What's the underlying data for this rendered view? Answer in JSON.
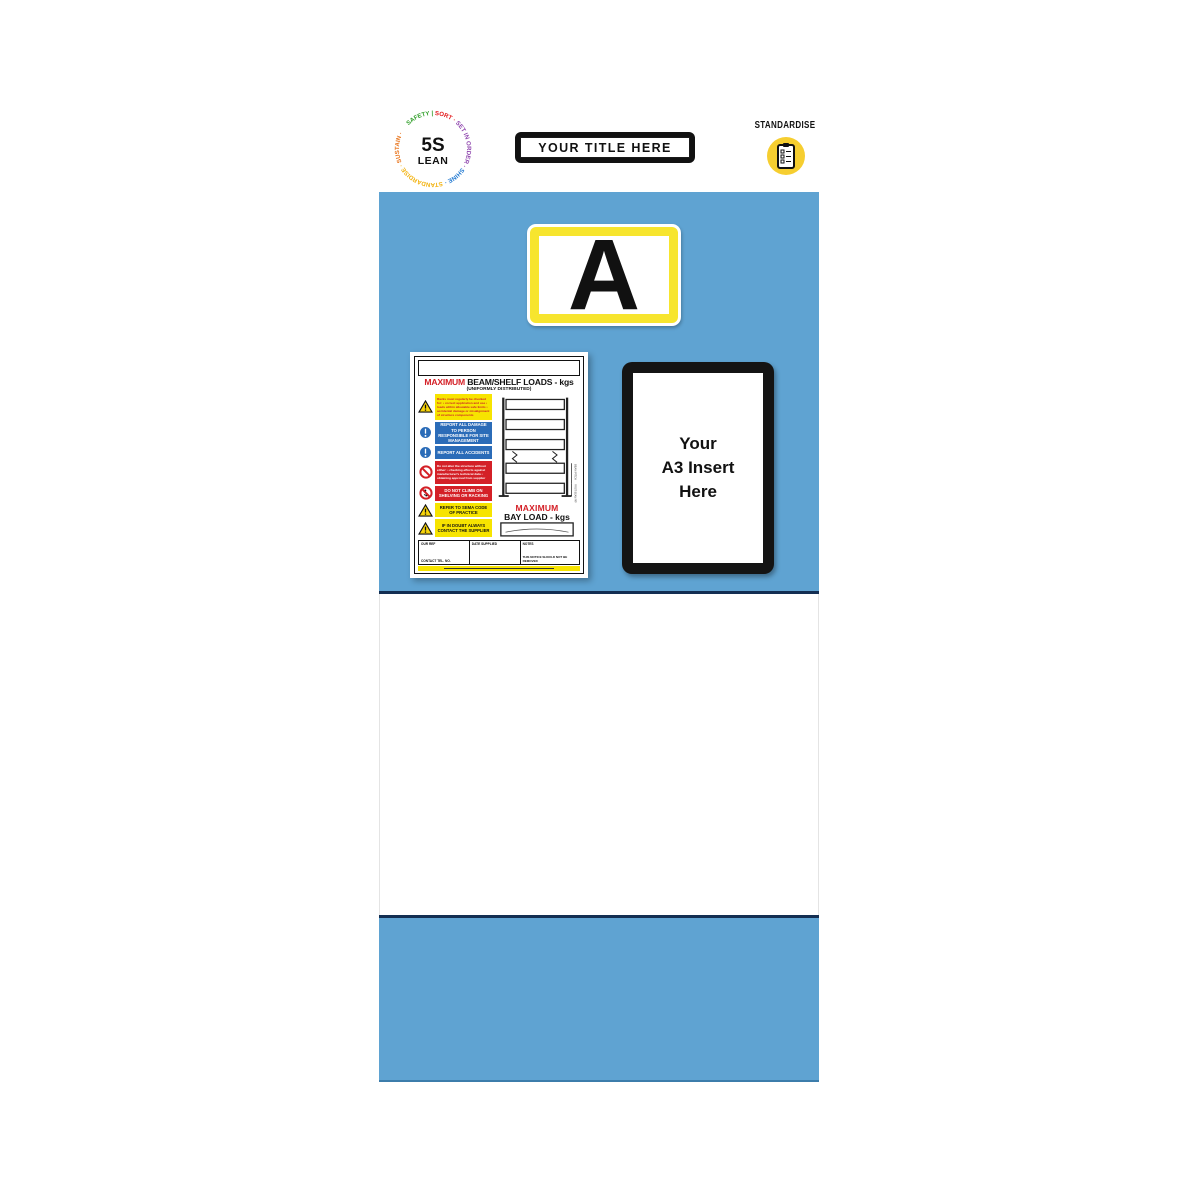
{
  "page": {
    "background": "#ffffff"
  },
  "header": {
    "logo": {
      "center_top": "5S",
      "center_bottom": "LEAN",
      "ring": [
        {
          "text": "SAFETY | ",
          "color": "#33a02c"
        },
        {
          "text": "SORT · ",
          "color": "#e31a1c"
        },
        {
          "text": "SET IN ORDER · ",
          "color": "#8e44ad"
        },
        {
          "text": "SHINE · ",
          "color": "#1f78d1"
        },
        {
          "text": "STANDARDISE · ",
          "color": "#f2b20f"
        },
        {
          "text": "SUSTAIN ·",
          "color": "#e8731a"
        }
      ]
    },
    "title_plate": {
      "label": "YOUR TITLE HERE"
    },
    "standardise": {
      "label": "STANDARDISE",
      "icon": "checklist-clipboard-icon",
      "circle_color": "#f6ce30"
    }
  },
  "board": {
    "panel_color": "#5fa3d2",
    "edge_line_color": "#132e52",
    "location_card": {
      "letter": "A",
      "border_color": "#f7e52e"
    },
    "a3_insert": {
      "line1": "Your",
      "line2": "A3 Insert",
      "line3": "Here"
    },
    "load_notice": {
      "title_red": "MAXIMUM",
      "title_black": " BEAM/SHELF LOADS - kgs",
      "subtitle": "(UNIFORMLY DISTRIBUTED)",
      "colors": {
        "yellow": "#f7e400",
        "blue": "#2b6cb8",
        "red": "#d42027"
      },
      "rows": [
        {
          "icon": "warning-triangle-icon",
          "style": "yellow",
          "text": "Racks must regularly be checked for: • correct application and use • loads within allowable safe limits • accidental damage or misalignment of structure components"
        },
        {
          "icon": "mandatory-exclamation-icon",
          "style": "blue",
          "text": "REPORT ALL DAMAGE TO PERSON RESPONSIBLE FOR SITE MANAGEMENT"
        },
        {
          "icon": "mandatory-exclamation-icon",
          "style": "blue",
          "text": "REPORT ALL ACCIDENTS"
        },
        {
          "icon": "prohibition-icon",
          "style": "red",
          "text": "Do not alter the structure without either: • checking effects against manufacturer's technical data • obtaining approval from supplier"
        },
        {
          "icon": "no-climbing-icon",
          "style": "red",
          "text": "DO NOT CLIMB ON SHELVING OR RACKING"
        },
        {
          "icon": "warning-triangle-icon",
          "style": "yellow",
          "text": "REFER TO SEMA CODE OF PRACTICE"
        },
        {
          "icon": "warning-triangle-icon",
          "style": "yellow",
          "text": "IF IN DOUBT ALWAYS CONTACT THE SUPPLIER"
        }
      ],
      "bay_red": "MAXIMUM",
      "bay_black": "BAY LOAD - kgs",
      "diagram_labels": {
        "beam_pitch": "BEAM PITCH",
        "first_beam_pitch": "FIRST BEAM PITCH"
      },
      "footer": {
        "our_ref": "OUR REF",
        "contact": "CONTACT TEL. NO.",
        "date_supplied": "DATE SUPPLIED",
        "notes": "NOTES",
        "warning": "THIS NOTICE SHOULD NOT BE REMOVED"
      }
    }
  }
}
